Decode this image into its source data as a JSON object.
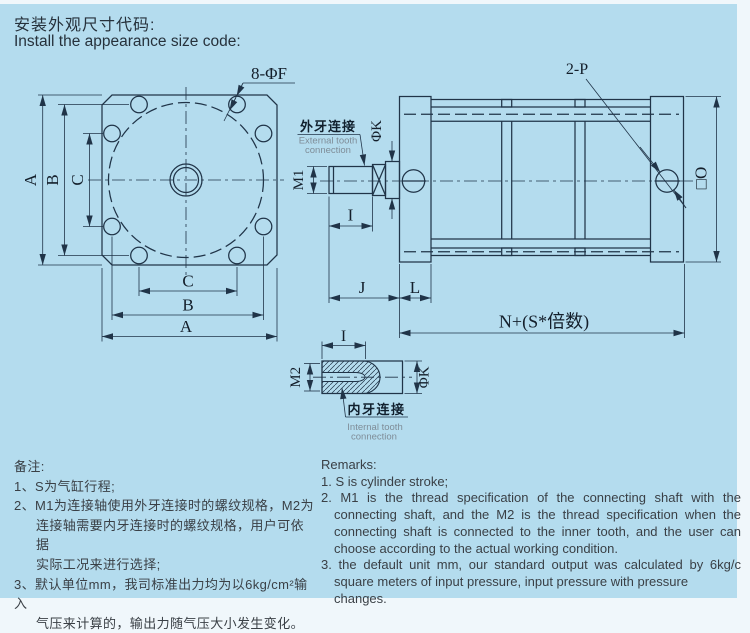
{
  "title": {
    "zh": "安装外观尺寸代码:",
    "en": "Install the appearance size code:"
  },
  "front": {
    "callout": "8-ΦF",
    "a": "A",
    "b": "B",
    "c": "C"
  },
  "side": {
    "ports": "2-P",
    "m1": "M1",
    "k": "ΦK",
    "i": "I",
    "j": "J",
    "l": "L",
    "n": "N+(S*倍数)",
    "o": "□O",
    "ext": {
      "zh": "外牙连接",
      "en1": "External tooth",
      "en2": "connection"
    }
  },
  "detail": {
    "m2": "M2",
    "i": "I",
    "k": "ΦK",
    "int": {
      "zh": "内牙连接",
      "en1": "Internal tooth",
      "en2": "connection"
    }
  },
  "remarks_zh": {
    "heading": "备注:",
    "lines": [
      "1、S为气缸行程;",
      "2、M1为连接轴使用外牙连接时的螺纹规格，M2为",
      "连接轴需要内牙连接时的螺纹规格，用户可依据",
      "实际工况来进行选择;",
      "3、默认单位mm，我司标准出力均为以6kg/cm²输入",
      "气压来计算的，输出力随气压大小发生变化。"
    ]
  },
  "remarks_en": {
    "heading": "Remarks:",
    "lines": [
      "1. S is cylinder stroke;",
      "2. M1 is the thread specification of the connecting shaft with the",
      "connecting shaft, and the M2 is the thread specification when the",
      "connecting shaft is connected to the inner tooth, and the user can",
      "choose according to the actual working condition.",
      "3. the default unit mm, our standard output was calculated by 6kg/c",
      "square meters of input pressure, input pressure with pressure changes."
    ]
  },
  "colors": {
    "panel_bg": "#b4dcee",
    "line": "#203448",
    "label_text": "#141f2b",
    "sub_label_text": "#7f8d98",
    "body_text": "#3a4046"
  }
}
